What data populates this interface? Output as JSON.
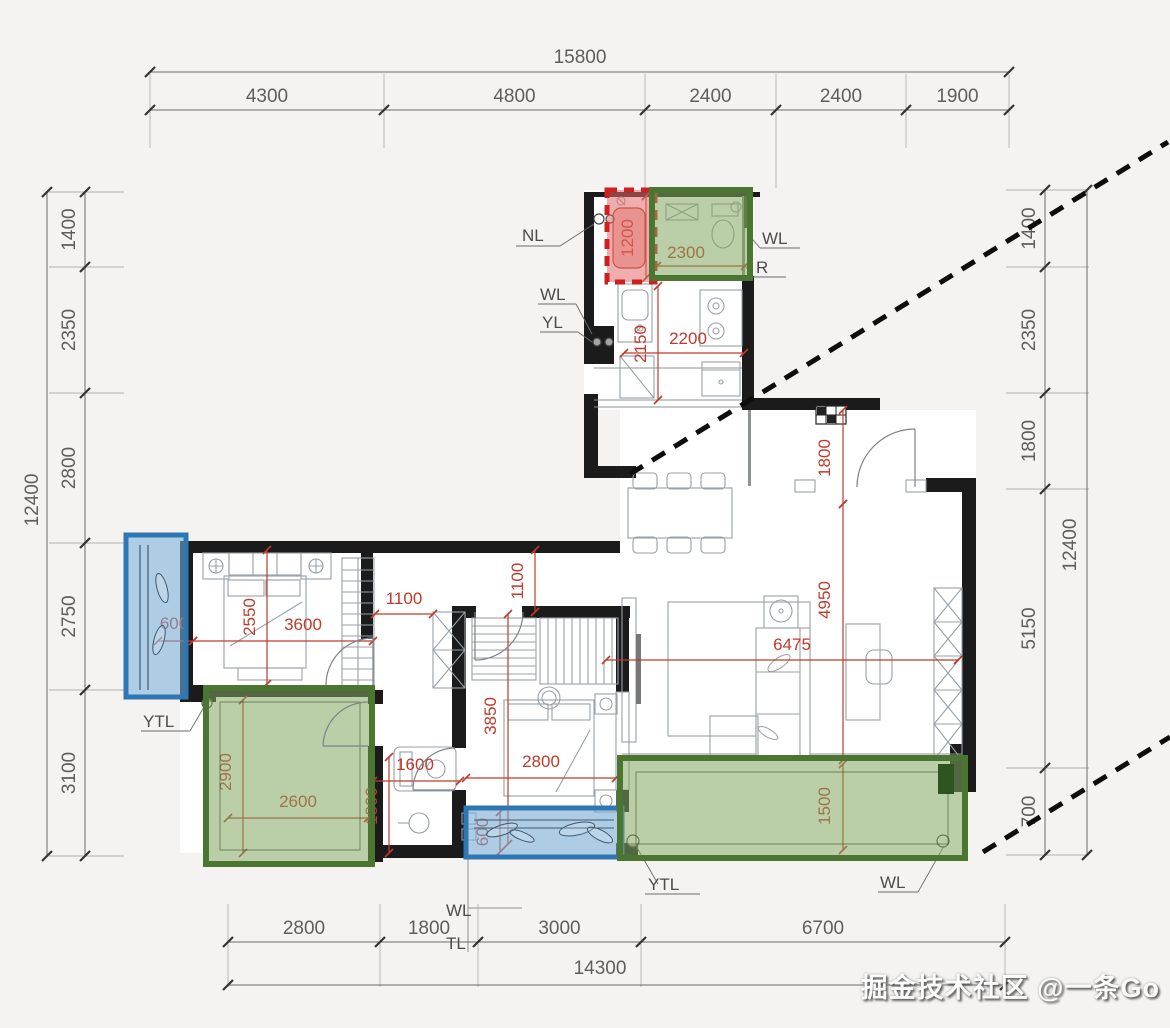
{
  "watermark": "掘金技术社区 @一条Go",
  "dimension_chains": {
    "top": {
      "total": "15800",
      "segments": [
        "4300",
        "4800",
        "2400",
        "2400",
        "1900"
      ]
    },
    "left": {
      "total": "12400",
      "segments": [
        "1400",
        "2350",
        "2800",
        "2750",
        "3100"
      ]
    },
    "right": {
      "total": "12400",
      "segments": [
        "1400",
        "2350",
        "1800",
        "5150",
        "700"
      ]
    },
    "bottom": {
      "total": "14300",
      "segments": [
        "2800",
        "1800",
        "3000",
        "6700"
      ]
    }
  },
  "interior_dimensions": [
    {
      "id": "north-closet-width",
      "value": "1200"
    },
    {
      "id": "north-bath-width",
      "value": "2300"
    },
    {
      "id": "kitchen-depth",
      "value": "2150"
    },
    {
      "id": "kitchen-width",
      "value": "2200"
    },
    {
      "id": "entry-depth",
      "value": "1800"
    },
    {
      "id": "living-depth",
      "value": "4950"
    },
    {
      "id": "living-width",
      "value": "6475"
    },
    {
      "id": "south-balcony-depth",
      "value": "1500"
    },
    {
      "id": "hall-width",
      "value": "1100"
    },
    {
      "id": "hall-depth",
      "value": "1100"
    },
    {
      "id": "bedroom1-depth",
      "value": "2550"
    },
    {
      "id": "bedroom1-width",
      "value": "3600"
    },
    {
      "id": "west-bay-depth",
      "value": "600"
    },
    {
      "id": "bedroom2-depth",
      "value": "3850"
    },
    {
      "id": "bedroom2-width",
      "value": "2800"
    },
    {
      "id": "bathroom-width",
      "value": "1600"
    },
    {
      "id": "bathroom-depth",
      "value": "1800"
    },
    {
      "id": "bedroom3-depth",
      "value": "2900"
    },
    {
      "id": "bedroom3-width",
      "value": "2600"
    },
    {
      "id": "south-bay-depth",
      "value": "600"
    }
  ],
  "pipe_labels": [
    {
      "id": "nl-north",
      "text": "NL"
    },
    {
      "id": "wl-kitchen",
      "text": "WL"
    },
    {
      "id": "yl-kitchen",
      "text": "YL"
    },
    {
      "id": "wl-north-bath",
      "text": "WL"
    },
    {
      "id": "r-north-bath",
      "text": "R"
    },
    {
      "id": "ytl-west",
      "text": "YTL"
    },
    {
      "id": "ytl-south-balcony",
      "text": "YTL"
    },
    {
      "id": "wl-south-balcony",
      "text": "WL"
    },
    {
      "id": "wl-bathroom-drain",
      "text": "WL"
    },
    {
      "id": "tl-bathroom-drain",
      "text": "TL"
    }
  ],
  "colors": {
    "wall": "#1b1b1b",
    "dimension_red": "#bf3a2b",
    "overlay_green_border": "#4a7631",
    "overlay_green_fill": "rgba(130,165,95,0.55)",
    "overlay_blue_border": "#2e77b5",
    "overlay_blue_fill": "rgba(120,170,210,0.6)",
    "overlay_red_border": "#cf1f1f",
    "overlay_red_fill": "rgba(226,106,106,0.55)"
  }
}
